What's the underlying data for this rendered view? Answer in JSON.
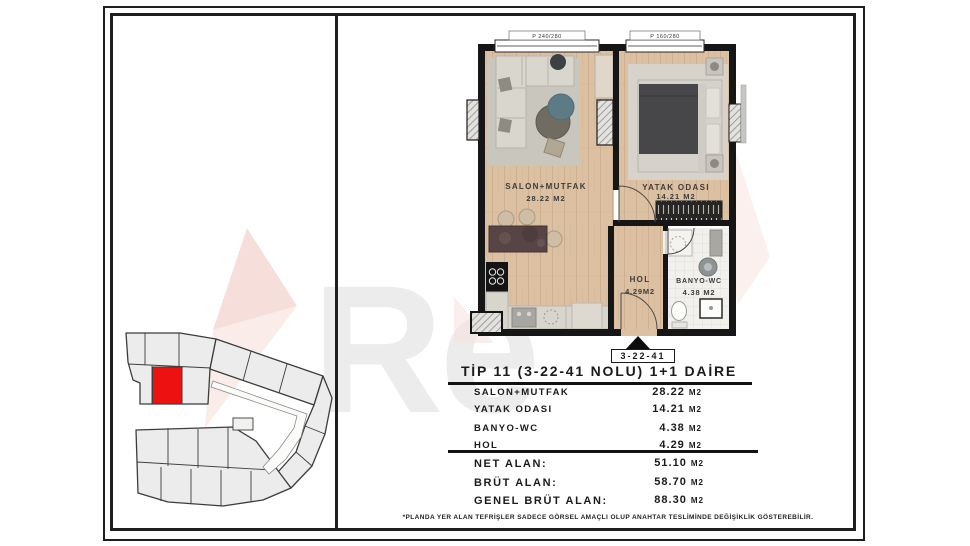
{
  "watermark": {
    "text": "Re"
  },
  "site_plan": {
    "highlight_color": "#ee1111",
    "unit_fill": "#ececec",
    "outline_color": "#3c3c3c"
  },
  "floor_plan": {
    "windows": [
      {
        "label": "P 240/280"
      },
      {
        "label": "P 160/280"
      }
    ],
    "rooms": {
      "salon": {
        "name": "SALON+MUTFAK",
        "area": "28.22 M2"
      },
      "yatak": {
        "name": "YATAK ODASI",
        "area": "14.21 M2"
      },
      "hol": {
        "name": "HOL",
        "area": "4.29M2"
      },
      "banyo": {
        "name": "BANYO-WC",
        "area": "4.38 M2"
      }
    },
    "marker_label": "3-22-41"
  },
  "info_table": {
    "title": "TİP 11 (3-22-41 NOLU) 1+1 DAİRE",
    "rooms": [
      {
        "label": "SALON+MUTFAK",
        "value": "28.22",
        "unit": "M2"
      },
      {
        "label": "YATAK ODASI",
        "value": "14.21",
        "unit": "M2"
      },
      {
        "label": "BANYO-WC",
        "value": "4.38",
        "unit": "M2"
      },
      {
        "label": "HOL",
        "value": "4.29",
        "unit": "M2"
      }
    ],
    "totals": [
      {
        "label": "NET ALAN:",
        "value": "51.10",
        "unit": "M2"
      },
      {
        "label": "BRÜT ALAN:",
        "value": "58.70",
        "unit": "M2"
      },
      {
        "label": "GENEL BRÜT ALAN:",
        "value": "88.30",
        "unit": "M2"
      }
    ],
    "footnote": "*PLANDA YER ALAN TEFRİŞLER SADECE GÖRSEL AMAÇLI OLUP ANAHTAR TESLİMİNDE DEĞİŞİKLİK GÖSTEREBİLİR."
  }
}
